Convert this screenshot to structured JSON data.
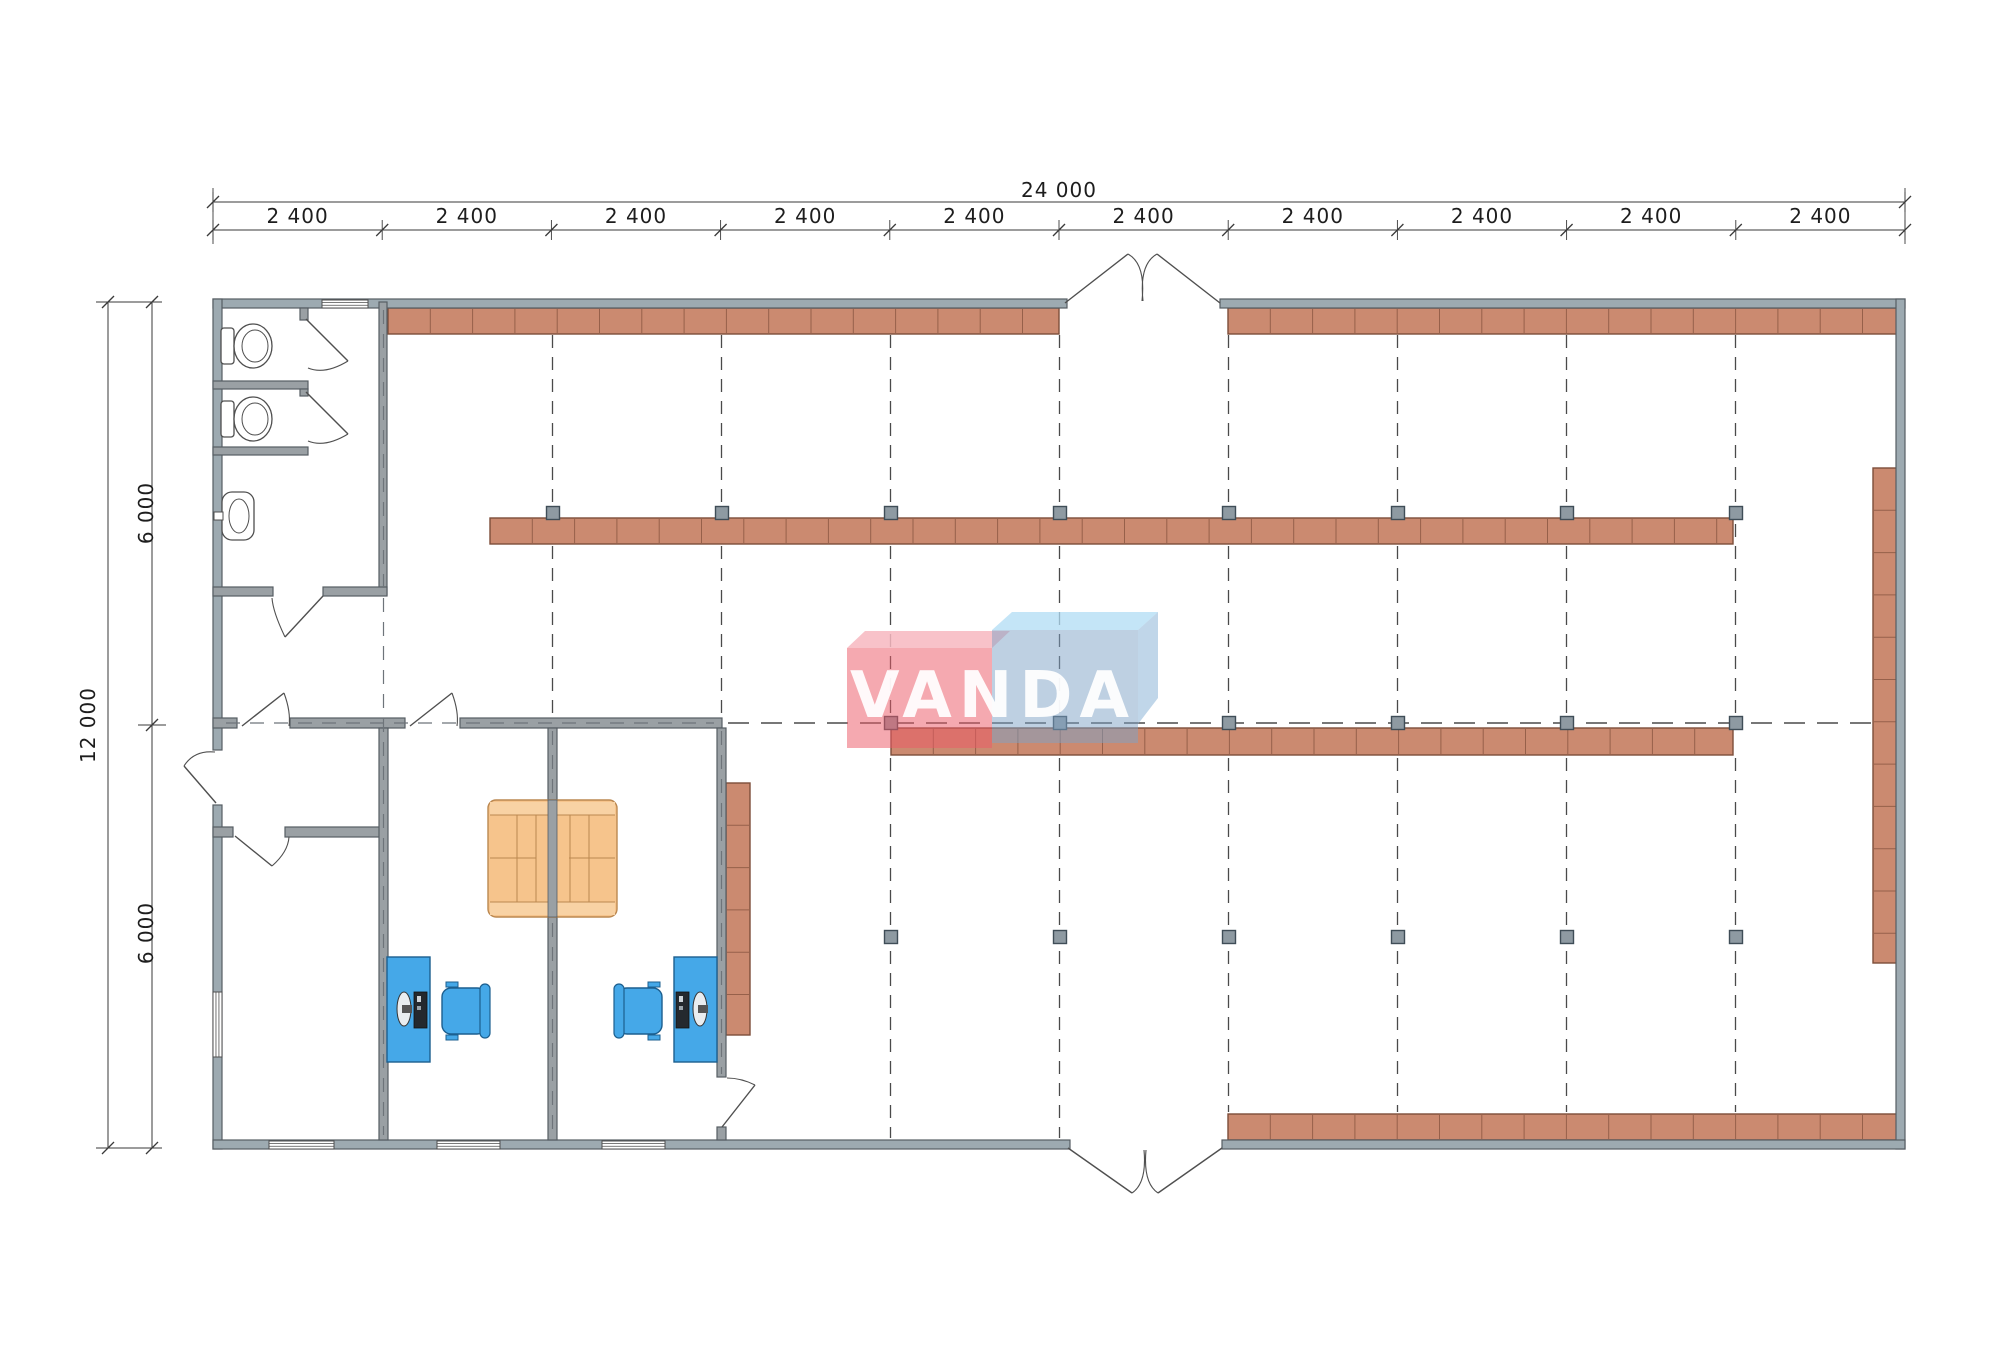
{
  "watermark": {
    "text": "VANDA"
  },
  "dimensions": {
    "total_width_label": "24 000",
    "bay_label": "2 400",
    "bay_count": 10,
    "total_height_label": "12 000",
    "half_height_label": "6 000"
  },
  "colors": {
    "wall": "#9aa0a4",
    "wall_outer": "#9daab1",
    "wall_stroke": "#565d63",
    "wall_dash": "#6e747a",
    "shelf": "#cb8a70",
    "shelf_stroke": "#7d4e3a",
    "shelf_divider": "#96604a",
    "column": "#8e9aa2",
    "column_stroke": "#3f4d57",
    "grid": "#4a4a4a",
    "blue_furniture": "#45a8e8",
    "blue_stroke": "#1c5f8f",
    "sofa": "#f6c48c",
    "sofa_cap": "#f8d2a4",
    "sofa_stroke": "#bb8850",
    "fixture": "#ffffff",
    "fixture_stroke": "#4f4f4f",
    "door": "#4f4f4f",
    "dim": "#3a3a3a",
    "logo_pink": "rgba(236,90,103,0.52)",
    "logo_pink_top": "rgba(247,183,192,0.85)",
    "logo_blue": "rgba(125,162,198,0.50)",
    "logo_blue_top": "rgba(176,220,244,0.75)",
    "logo_blue_side": "rgba(140,180,215,0.55)"
  },
  "plan": {
    "outer_walls": [
      [
        213,
        299,
        854,
        9
      ],
      [
        1220,
        299,
        685,
        9
      ],
      [
        213,
        299,
        9,
        451
      ],
      [
        213,
        805,
        9,
        344
      ],
      [
        1896,
        299,
        9,
        850
      ],
      [
        213,
        1140,
        857,
        9
      ],
      [
        1222,
        1140,
        683,
        9
      ]
    ],
    "inner_walls": [
      [
        379,
        302,
        8,
        293
      ],
      [
        213,
        381,
        95,
        8
      ],
      [
        213,
        447,
        95,
        8
      ],
      [
        300,
        308,
        8,
        12
      ],
      [
        300,
        389,
        8,
        7
      ],
      [
        213,
        587,
        60,
        9
      ],
      [
        323,
        587,
        64,
        9
      ],
      [
        213,
        718,
        24,
        10
      ],
      [
        290,
        718,
        115,
        10
      ],
      [
        460,
        718,
        262,
        10
      ],
      [
        213,
        827,
        20,
        10
      ],
      [
        285,
        827,
        99,
        10
      ],
      [
        379,
        728,
        9,
        412
      ],
      [
        548,
        728,
        9,
        412
      ],
      [
        717,
        728,
        9,
        349
      ],
      [
        717,
        1127,
        9,
        13
      ]
    ],
    "wall_dashes": [
      {
        "x1": 383.5,
        "y1": 310,
        "x2": 383.5,
        "y2": 1135
      },
      {
        "x1": 552.5,
        "y1": 731,
        "x2": 552.5,
        "y2": 1135
      },
      {
        "x1": 721.5,
        "y1": 731,
        "x2": 721.5,
        "y2": 1074
      },
      {
        "x1": 226,
        "y1": 723,
        "x2": 714,
        "y2": 723
      }
    ],
    "grid_v": [
      {
        "x": 552.5,
        "segs": [
          [
            335,
            506
          ],
          [
            524,
            716
          ]
        ]
      },
      {
        "x": 721.5,
        "segs": [
          [
            335,
            506
          ],
          [
            524,
            716
          ]
        ]
      },
      {
        "x": 890.5,
        "segs": [
          [
            335,
            506
          ],
          [
            524,
            715
          ],
          [
            758,
            929
          ],
          [
            951,
            1138
          ]
        ]
      },
      {
        "x": 1059.5,
        "segs": [
          [
            335,
            506
          ],
          [
            524,
            715
          ],
          [
            758,
            929
          ],
          [
            951,
            1138
          ]
        ]
      },
      {
        "x": 1228.5,
        "segs": [
          [
            335,
            506
          ],
          [
            524,
            715
          ],
          [
            758,
            929
          ],
          [
            951,
            1112
          ]
        ]
      },
      {
        "x": 1397.5,
        "segs": [
          [
            335,
            506
          ],
          [
            524,
            715
          ],
          [
            758,
            929
          ],
          [
            951,
            1112
          ]
        ]
      },
      {
        "x": 1566.5,
        "segs": [
          [
            335,
            506
          ],
          [
            524,
            715
          ],
          [
            758,
            929
          ],
          [
            951,
            1112
          ]
        ]
      },
      {
        "x": 1735.5,
        "segs": [
          [
            335,
            506
          ],
          [
            524,
            715
          ],
          [
            758,
            929
          ],
          [
            951,
            1112
          ]
        ]
      }
    ],
    "grid_h": {
      "y": 723,
      "x1": 728,
      "x2": 1896
    },
    "shelves_h": [
      {
        "x": 388,
        "y": 308,
        "w": 671,
        "h": 26
      },
      {
        "x": 1228,
        "y": 308,
        "w": 670,
        "h": 26
      },
      {
        "x": 490,
        "y": 518,
        "w": 1243,
        "h": 26
      },
      {
        "x": 891,
        "y": 728,
        "w": 842,
        "h": 27
      },
      {
        "x": 1228,
        "y": 1114,
        "w": 670,
        "h": 26
      }
    ],
    "shelves_v": [
      {
        "x": 726,
        "y": 783,
        "w": 24,
        "h": 252
      },
      {
        "x": 1873,
        "y": 468,
        "w": 25,
        "h": 495
      }
    ],
    "shelf_seg": 42.3,
    "columns": [
      [
        553,
        513
      ],
      [
        722,
        513
      ],
      [
        891,
        513
      ],
      [
        1060,
        513
      ],
      [
        1229,
        513
      ],
      [
        1398,
        513
      ],
      [
        1567,
        513
      ],
      [
        1736,
        513
      ],
      [
        891,
        723
      ],
      [
        1060,
        723
      ],
      [
        1229,
        723
      ],
      [
        1398,
        723
      ],
      [
        1567,
        723
      ],
      [
        1736,
        723
      ],
      [
        891,
        937
      ],
      [
        1060,
        937
      ],
      [
        1229,
        937
      ],
      [
        1398,
        937
      ],
      [
        1567,
        937
      ],
      [
        1736,
        937
      ]
    ],
    "column_size": 13,
    "windows": [
      {
        "x": 322,
        "y": 300,
        "w": 46,
        "h": 8,
        "o": "h"
      },
      {
        "x": 213,
        "y": 992,
        "w": 9,
        "h": 65,
        "o": "v"
      },
      {
        "x": 269,
        "y": 1141,
        "w": 65,
        "h": 8,
        "o": "h"
      },
      {
        "x": 437,
        "y": 1141,
        "w": 63,
        "h": 8,
        "o": "h"
      },
      {
        "x": 602,
        "y": 1141,
        "w": 63,
        "h": 8,
        "o": "h"
      }
    ],
    "doors": [
      {
        "n": "entrance-top-leaf-left",
        "line": "M1065,303 L1128,254",
        "arc": "M1128,254 Q1146,264 1142,301"
      },
      {
        "n": "entrance-top-leaf-right",
        "line": "M1220,303 L1157,254",
        "arc": "M1157,254 Q1139,264 1143,301"
      },
      {
        "n": "entrance-bottom-leaf-left",
        "line": "M1068,1148 L1132,1193",
        "arc": "M1132,1193 Q1147,1183 1144,1150"
      },
      {
        "n": "entrance-bottom-leaf-right",
        "line": "M1222,1148 L1158,1193",
        "arc": "M1158,1193 Q1143,1183 1146,1150"
      },
      {
        "n": "entrance-left-leaf",
        "line": "M216,803 L184,766",
        "arc": "M184,766 Q194,750 215,752"
      },
      {
        "n": "office-door-1",
        "line": "M242,726 L284,693",
        "arc": "M284,693 Q291,712 289,726"
      },
      {
        "n": "office-door-2",
        "line": "M410,726 L452,693",
        "arc": "M452,693 Q459,712 457,726"
      },
      {
        "n": "lavatory-door",
        "line": "M323,596 L285,637",
        "arc": "M285,637 Q273,612 272,598"
      },
      {
        "n": "vestibule-door",
        "line": "M235,836 L272,866",
        "arc": "M272,866 Q288,852 289,837"
      },
      {
        "n": "stall-door-1",
        "line": "M306,319 L348,361",
        "arc": "M348,361 Q325,375 308,368"
      },
      {
        "n": "stall-door-2",
        "line": "M306,392 L348,434",
        "arc": "M348,434 Q325,448 308,441"
      },
      {
        "n": "hall-door",
        "line": "M722,1127 L755,1085",
        "arc": "M755,1085 Q741,1078 727,1078"
      }
    ],
    "desks": [
      {
        "x": 387,
        "y": 957,
        "w": 43,
        "h": 105,
        "monitor_cx": 404,
        "monitor_cy": 1009,
        "kb": [
          414,
          992,
          13,
          36
        ]
      },
      {
        "x": 674,
        "y": 957,
        "w": 43,
        "h": 105,
        "monitor_cx": 700,
        "monitor_cy": 1009,
        "kb": [
          676,
          992,
          13,
          36
        ]
      }
    ],
    "chairs": [
      {
        "x": 442,
        "y": 988,
        "w": 44,
        "h": 46,
        "back": "right"
      },
      {
        "x": 618,
        "y": 988,
        "w": 44,
        "h": 46,
        "back": "left"
      }
    ],
    "sofa": {
      "x": 488,
      "y": 800,
      "w": 129,
      "h": 117,
      "wall_band": [
        548,
        800,
        9,
        117
      ]
    },
    "toilets": [
      {
        "tank": [
          221,
          328,
          13,
          36
        ],
        "cx": 253,
        "cy": 346
      },
      {
        "tank": [
          221,
          401,
          13,
          36
        ],
        "cx": 253,
        "cy": 419
      }
    ],
    "sink": {
      "rect": [
        222,
        492,
        32,
        48
      ],
      "cx": 239,
      "cy": 516,
      "tap": [
        214,
        512,
        9,
        8
      ]
    },
    "dims": {
      "lines": [
        [
          213,
          202,
          1905,
          202
        ],
        [
          213,
          230,
          1905,
          230
        ],
        [
          108,
          302,
          108,
          1148
        ],
        [
          152,
          302,
          152,
          1148
        ]
      ],
      "ext_lines": [
        [
          213,
          188,
          213,
          244
        ],
        [
          1905,
          188,
          1905,
          244
        ],
        [
          96,
          302,
          162,
          302
        ],
        [
          96,
          1148,
          162,
          1148
        ],
        [
          138,
          725,
          166,
          725
        ]
      ],
      "ticks_h": [
        [
          213,
          202
        ],
        [
          1905,
          202
        ]
      ],
      "chain_y": 230,
      "chain_x0": 213,
      "chain_pitch": 169.2,
      "ticks_v": [
        [
          108,
          302
        ],
        [
          108,
          1148
        ],
        [
          152,
          302
        ],
        [
          152,
          725
        ],
        [
          152,
          1148
        ]
      ]
    },
    "logo": {
      "pink_top": "847,648 865,631 1010,631 992,648",
      "pink_front": [
        847,
        648,
        145,
        100
      ],
      "blue_top": "992,630 1012,612 1158,612 1138,630",
      "blue_front": [
        992,
        630,
        146,
        113
      ],
      "blue_side": "1138,630 1158,612 1158,698 1138,724"
    }
  }
}
